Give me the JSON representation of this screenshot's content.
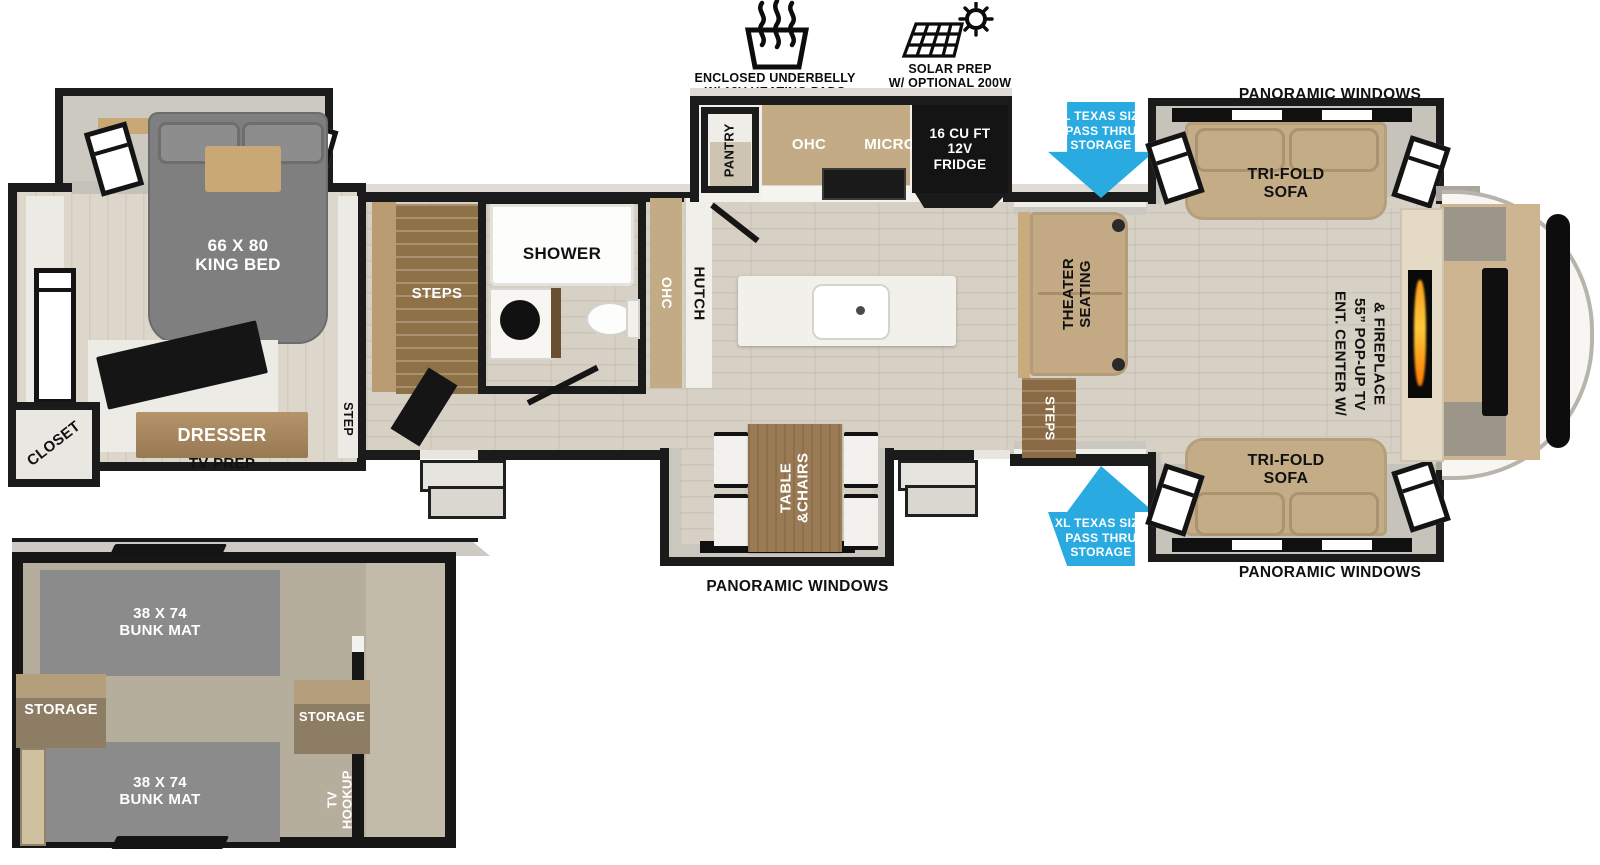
{
  "colors": {
    "arrow_blue": "#29ABE2",
    "wall_black": "#1b1b1b",
    "floor_wood": "#d7d0c4",
    "sofa_tan": "#c4ac86",
    "cabinet_wood": "#9a7b55",
    "bed_gray": "#7f7f7f",
    "bunk_mat_gray": "#8b8b8b"
  },
  "features": {
    "underbelly": "ENCLOSED UNDERBELLY\nW/ 12V HEATING PADS",
    "solar": "SOLAR PREP\nW/ OPTIONAL 200W\nSOLAR PACKAGE"
  },
  "exterior": {
    "panoramic_top": "PANORAMIC WINDOWS",
    "panoramic_bottom_right": "PANORAMIC WINDOWS",
    "panoramic_bottom_center": "PANORAMIC WINDOWS",
    "pass_thru_top": "XL TEXAS SIZE\nPASS THRU\nSTORAGE",
    "pass_thru_bottom": "XL TEXAS SIZE\nPASS THRU\nSTORAGE"
  },
  "bedroom": {
    "king_bed": "66 X 80\nKING BED",
    "closet": "CLOSET",
    "dresser": "DRESSER",
    "tv_prep": "TV PREP",
    "step": "STEP"
  },
  "bath_mid": {
    "shower": "SHOWER",
    "stairs_steps": "STEPS",
    "ohc": "OHC",
    "hutch": "HUTCH"
  },
  "kitchen": {
    "pantry": "PANTRY",
    "ohc": "OHC",
    "micro": "MICRO",
    "fridge": "16 CU FT\n12V\nFRIDGE",
    "table_chairs": "TABLE\n&CHAIRS"
  },
  "living": {
    "sofa_top": "TRI-FOLD\nSOFA",
    "sofa_bottom": "TRI-FOLD\nSOFA",
    "theater": "THEATER\nSEATING",
    "entry_steps": "STEPS",
    "ent_center": "ENT. CENTER W/\n55” POP-UP TV\n& FIREPLACE"
  },
  "bunkroom": {
    "bunk_top": "38 X 74\nBUNK MAT",
    "bunk_bottom": "38 X 74\nBUNK MAT",
    "storage_left": "STORAGE",
    "storage_right": "STORAGE",
    "tv_hookup": "TV\nHOOKUP"
  }
}
